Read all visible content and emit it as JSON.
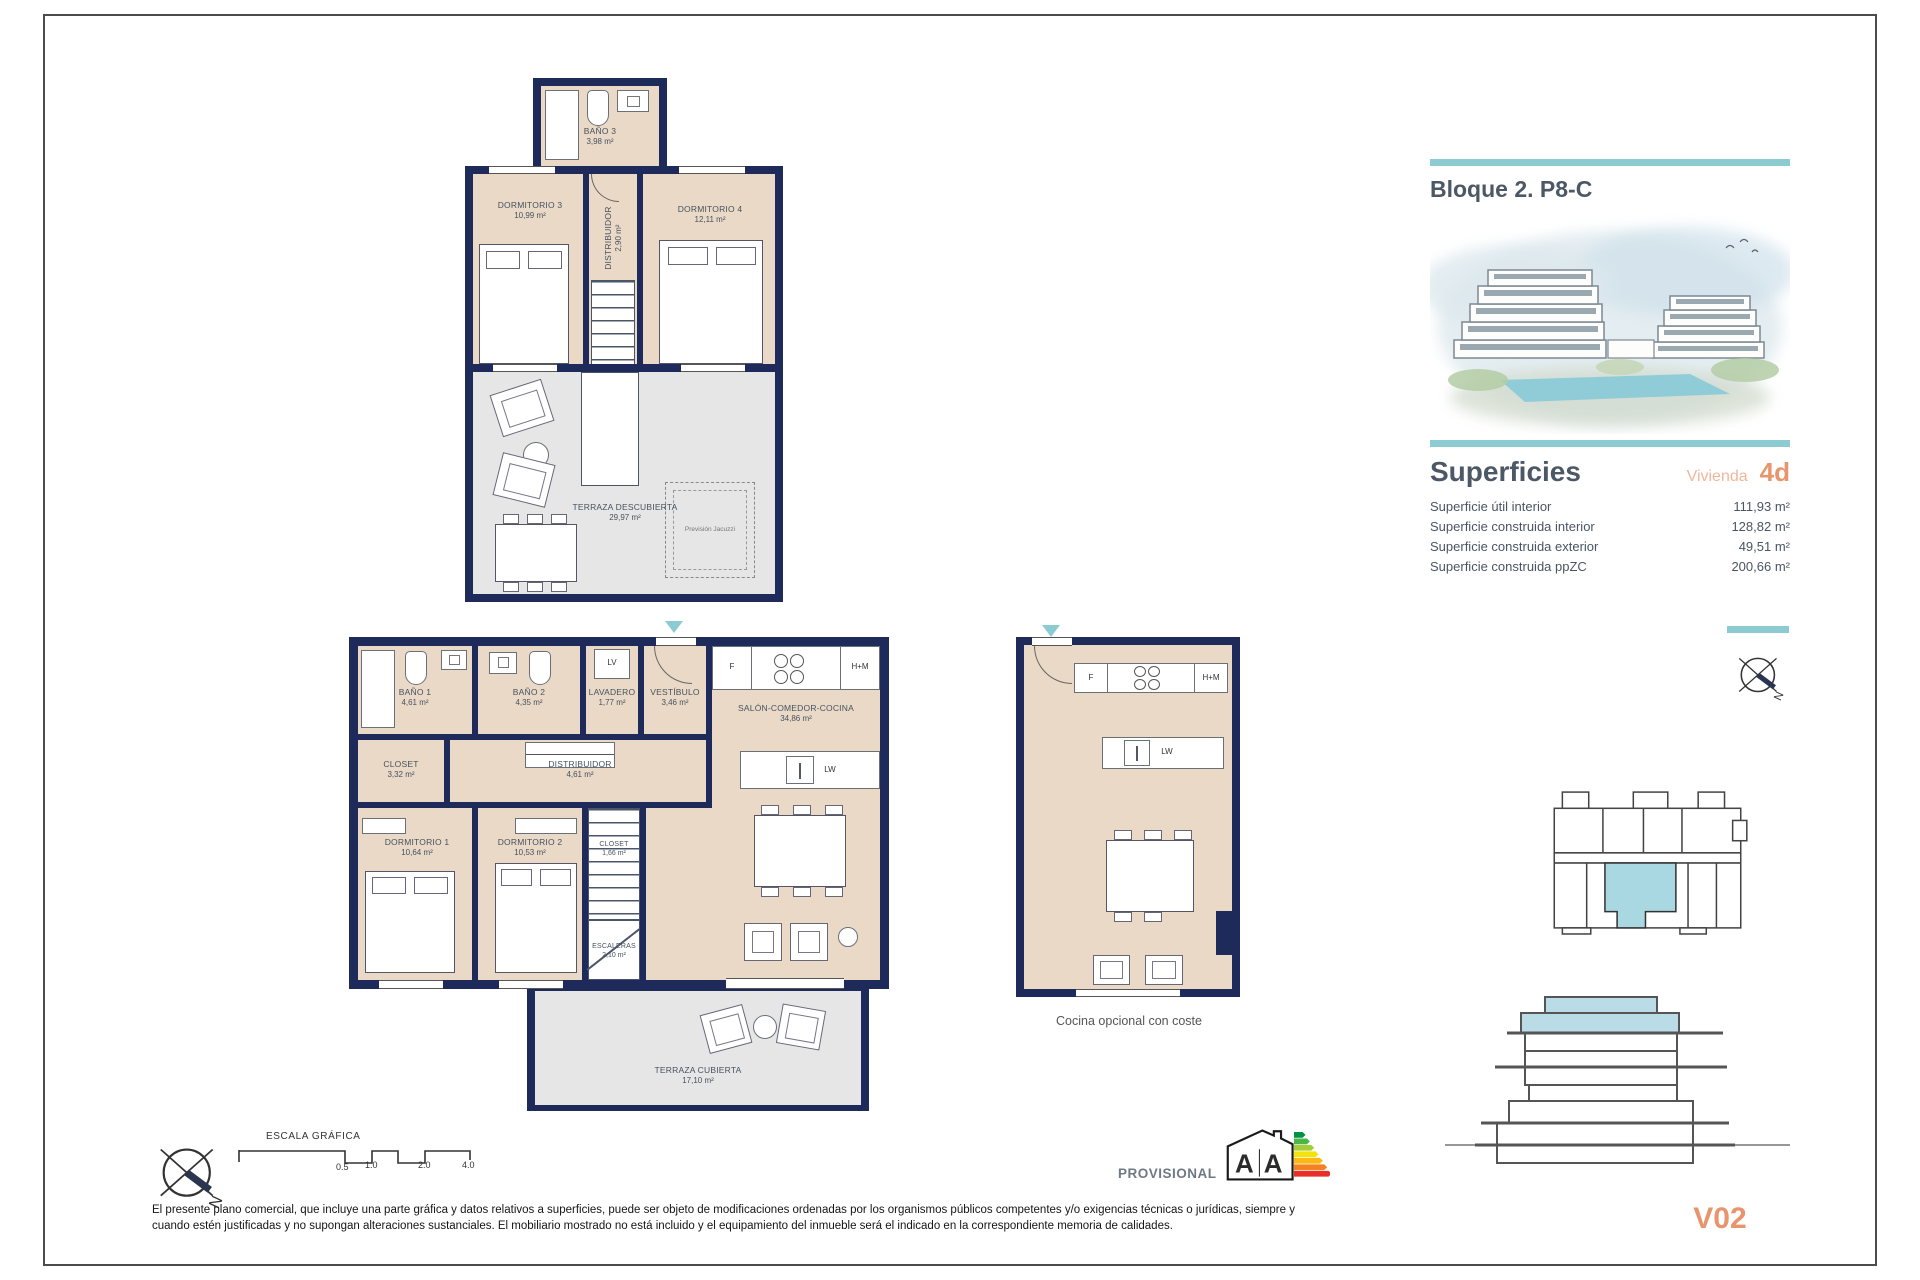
{
  "colors": {
    "accent_teal": "#8ccbd1",
    "wall_navy": "#1e2a5a",
    "floor_beige": "#ead9c6",
    "terrace_gray": "#e6e6e6",
    "accent_orange": "#e8946c",
    "heading_slate": "#4d5866"
  },
  "header": {
    "title": "Bloque 2. P8-C"
  },
  "superficies": {
    "title": "Superficies",
    "vivienda_label": "Vivienda",
    "vivienda_code": "4d",
    "rows": [
      {
        "label": "Superficie útil interior",
        "value": "111,93 m²"
      },
      {
        "label": "Superficie construida interior",
        "value": "128,82 m²"
      },
      {
        "label": "Superficie construida exterior",
        "value": "49,51 m²"
      },
      {
        "label": "Superficie construida ppZC",
        "value": "200,66 m²"
      }
    ]
  },
  "upper_plan": {
    "bano3": {
      "name": "BAÑO 3",
      "area": "3,98 m²"
    },
    "dormitorio3": {
      "name": "DORMITORIO 3",
      "area": "10,99 m²"
    },
    "dormitorio4": {
      "name": "DORMITORIO 4",
      "area": "12,11 m²"
    },
    "distribuidor": {
      "name": "DISTRIBUIDOR",
      "area": "2,90 m²"
    },
    "terraza": {
      "name": "TERRAZA DESCUBIERTA",
      "area": "29,97 m²"
    },
    "jacuzzi": "Previsión Jacuzzi"
  },
  "lower_plan": {
    "bano1": {
      "name": "BAÑO 1",
      "area": "4,61 m²"
    },
    "bano2": {
      "name": "BAÑO 2",
      "area": "4,35 m²"
    },
    "lavadero": {
      "name": "LAVADERO",
      "area": "1,77 m²"
    },
    "vestibulo": {
      "name": "VESTÍBULO",
      "area": "3,46 m²"
    },
    "closet": {
      "name": "CLOSET",
      "area": "3,32 m²"
    },
    "distribuidor": {
      "name": "DISTRIBUIDOR",
      "area": "4,61 m²"
    },
    "salon": {
      "name": "SALÓN-COMEDOR-COCINA",
      "area": "34,86 m²"
    },
    "dormitorio1": {
      "name": "DORMITORIO 1",
      "area": "10,64 m²"
    },
    "dormitorio2": {
      "name": "DORMITORIO 2",
      "area": "10,53 m²"
    },
    "closet2": {
      "name": "CLOSET",
      "area": "1,66 m²"
    },
    "escaleras": {
      "name": "ESCALERAS",
      "area": "2,10 m²"
    },
    "terraza": {
      "name": "TERRAZA CUBIERTA",
      "area": "17,10 m²"
    },
    "appliances": {
      "fridge": "F",
      "oven": "H+M",
      "washer": "LV",
      "dishwasher": "LW"
    }
  },
  "optional_plan": {
    "caption": "Cocina opcional con coste",
    "appliances": {
      "fridge": "F",
      "oven": "H+M",
      "dishwasher": "LW"
    }
  },
  "scale_bar": {
    "title": "ESCALA GRÁFICA",
    "ticks": [
      "0.5",
      "1.0",
      "2.0",
      "4.0"
    ]
  },
  "compass": {
    "north": "N"
  },
  "footer": {
    "provisional": "PROVISIONAL",
    "energy": {
      "letter_left": "A",
      "letter_right": "A"
    },
    "disclaimer": "El presente plano comercial, que incluye una parte gráfica y datos relativos a superficies, puede ser objeto de modificaciones ordenadas por los organismos públicos competentes y/o exigencias técnicas o jurídicas, siempre y cuando estén justificadas y no supongan alteraciones sustanciales. El mobiliario mostrado no está incluido y el equipamiento del inmueble será el indicado en la correspondiente memoria de calidades."
  },
  "unit_ref": "V02"
}
